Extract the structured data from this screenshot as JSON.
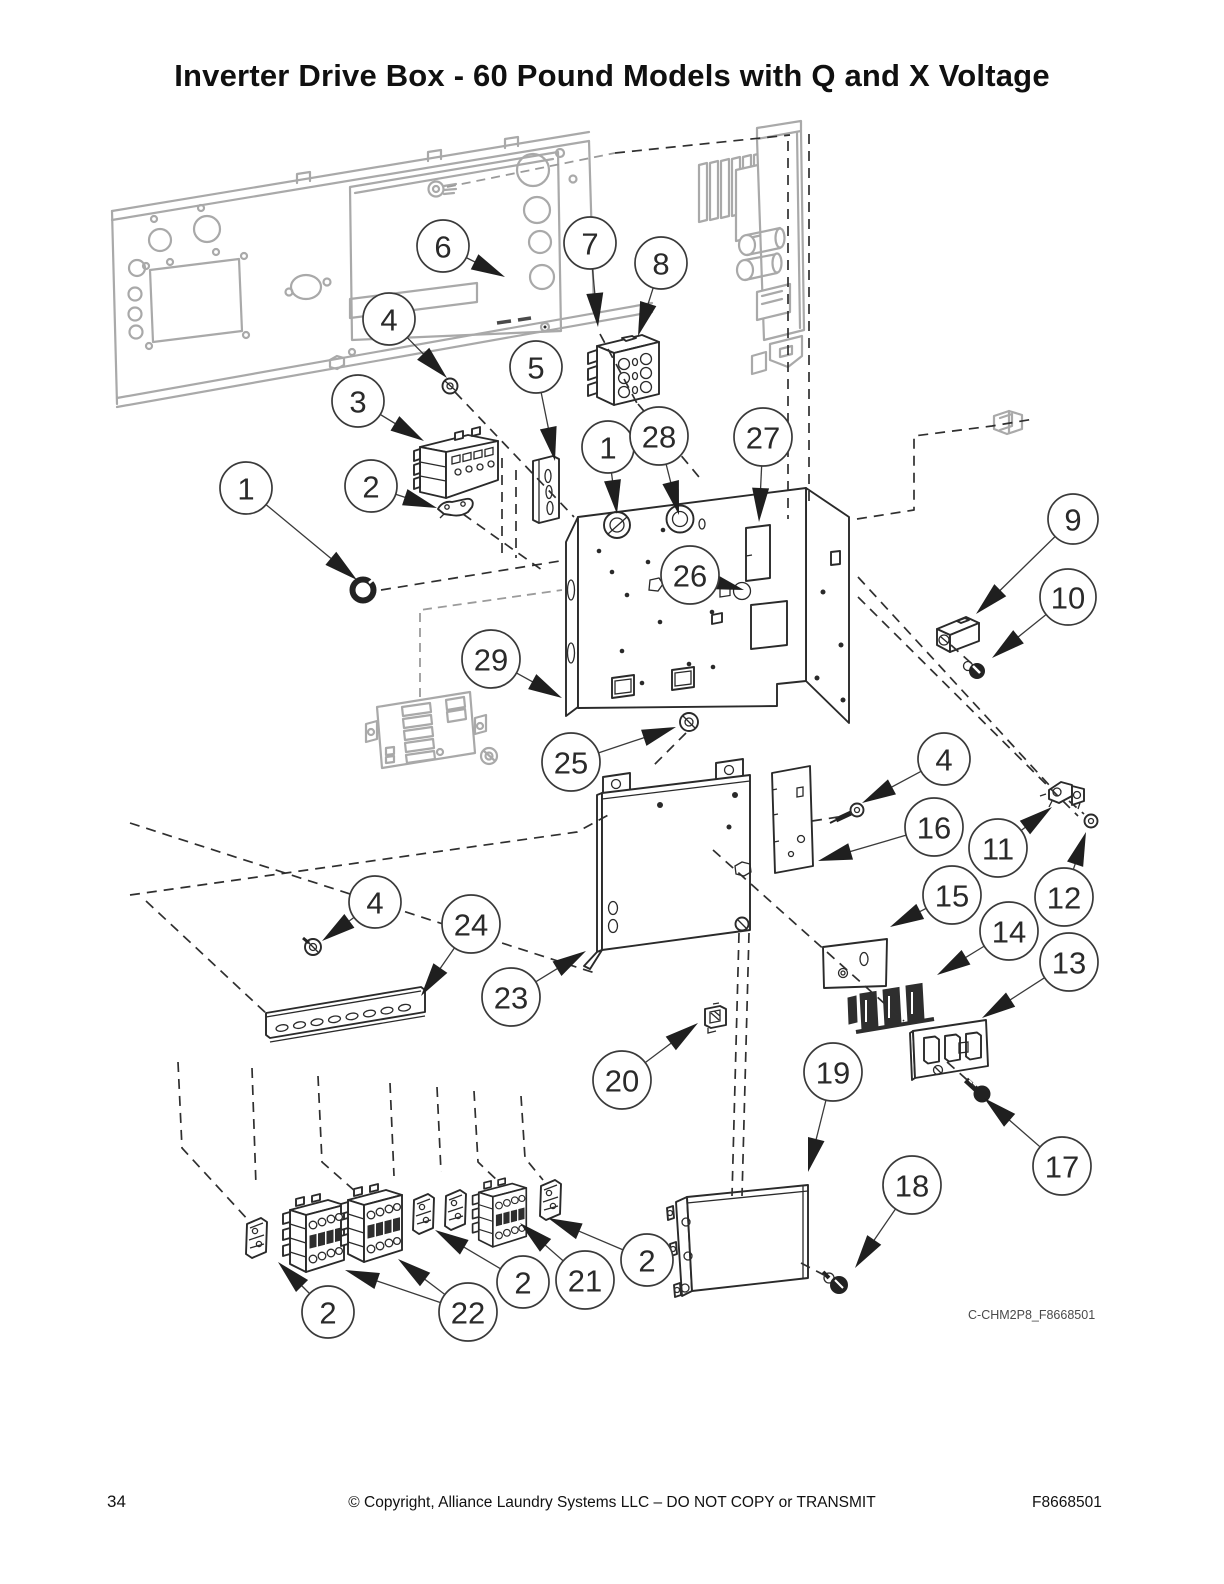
{
  "title": "Inverter Drive Box - 60 Pound Models with Q and X Voltage",
  "diagram_label": "C-CHM2P8_F8668501",
  "footer": {
    "page_number": "34",
    "copyright": "© Copyright, Alliance Laundry Systems LLC – DO NOT COPY or TRANSMIT",
    "document_number": "F8668501"
  },
  "colors": {
    "ink": "#2a2a2a",
    "gray": "#a9a9a9",
    "callout_stroke": "#3a3a3a"
  },
  "callouts": [
    {
      "n": "1",
      "x": 246,
      "y": 488,
      "r": 26,
      "tips": [
        [
          357,
          580
        ]
      ]
    },
    {
      "n": "2",
      "x": 371,
      "y": 486,
      "r": 26,
      "tips": [
        [
          437,
          508
        ]
      ]
    },
    {
      "n": "3",
      "x": 358,
      "y": 401,
      "r": 26,
      "tips": [
        [
          424,
          441
        ]
      ]
    },
    {
      "n": "4",
      "x": 389,
      "y": 319,
      "r": 26,
      "tips": [
        [
          447,
          378
        ]
      ]
    },
    {
      "n": "5",
      "x": 536,
      "y": 367,
      "r": 26,
      "tips": [
        [
          555,
          461
        ]
      ]
    },
    {
      "n": "6",
      "x": 443,
      "y": 246,
      "r": 26,
      "tips": [
        [
          505,
          277
        ]
      ]
    },
    {
      "n": "7",
      "x": 590,
      "y": 243,
      "r": 26,
      "tips": [
        [
          598,
          327
        ]
      ]
    },
    {
      "n": "8",
      "x": 661,
      "y": 263,
      "r": 26,
      "tips": [
        [
          638,
          336
        ]
      ]
    },
    {
      "n": "1",
      "x": 608,
      "y": 447,
      "r": 26,
      "tips": [
        [
          617,
          514
        ]
      ]
    },
    {
      "n": "28",
      "x": 659,
      "y": 436,
      "r": 29,
      "tips": [
        [
          679,
          515
        ]
      ]
    },
    {
      "n": "27",
      "x": 763,
      "y": 437,
      "r": 29,
      "tips": [
        [
          759,
          522
        ]
      ]
    },
    {
      "n": "26",
      "x": 690,
      "y": 575,
      "r": 29,
      "tips": [
        [
          744,
          590
        ]
      ]
    },
    {
      "n": "9",
      "x": 1073,
      "y": 519,
      "r": 25,
      "tips": [
        [
          976,
          614
        ]
      ]
    },
    {
      "n": "10",
      "x": 1068,
      "y": 597,
      "r": 28,
      "tips": [
        [
          992,
          658
        ]
      ]
    },
    {
      "n": "29",
      "x": 491,
      "y": 659,
      "r": 29,
      "tips": [
        [
          562,
          698
        ]
      ]
    },
    {
      "n": "25",
      "x": 571,
      "y": 762,
      "r": 29,
      "tips": [
        [
          676,
          727
        ]
      ]
    },
    {
      "n": "4",
      "x": 944,
      "y": 759,
      "r": 26,
      "tips": [
        [
          862,
          803
        ]
      ]
    },
    {
      "n": "16",
      "x": 934,
      "y": 827,
      "r": 29,
      "tips": [
        [
          818,
          861
        ]
      ]
    },
    {
      "n": "11",
      "x": 998,
      "y": 848,
      "r": 29,
      "tips": [
        [
          1052,
          807
        ]
      ]
    },
    {
      "n": "12",
      "x": 1064,
      "y": 897,
      "r": 29,
      "tips": [
        [
          1086,
          832
        ]
      ]
    },
    {
      "n": "15",
      "x": 952,
      "y": 895,
      "r": 29,
      "tips": [
        [
          890,
          927
        ]
      ]
    },
    {
      "n": "14",
      "x": 1009,
      "y": 931,
      "r": 29,
      "tips": [
        [
          937,
          975
        ]
      ]
    },
    {
      "n": "13",
      "x": 1069,
      "y": 962,
      "r": 29,
      "tips": [
        [
          982,
          1018
        ]
      ]
    },
    {
      "n": "4",
      "x": 375,
      "y": 902,
      "r": 26,
      "tips": [
        [
          322,
          941
        ]
      ]
    },
    {
      "n": "24",
      "x": 471,
      "y": 924,
      "r": 29,
      "tips": [
        [
          421,
          996
        ]
      ]
    },
    {
      "n": "23",
      "x": 511,
      "y": 997,
      "r": 29,
      "tips": [
        [
          586,
          951
        ]
      ]
    },
    {
      "n": "20",
      "x": 622,
      "y": 1080,
      "r": 29,
      "tips": [
        [
          698,
          1023
        ]
      ]
    },
    {
      "n": "19",
      "x": 833,
      "y": 1072,
      "r": 29,
      "tips": [
        [
          808,
          1172
        ]
      ]
    },
    {
      "n": "18",
      "x": 912,
      "y": 1185,
      "r": 29,
      "tips": [
        [
          855,
          1268
        ]
      ]
    },
    {
      "n": "17",
      "x": 1062,
      "y": 1166,
      "r": 29,
      "tips": [
        [
          984,
          1098
        ]
      ]
    },
    {
      "n": "2",
      "x": 328,
      "y": 1312,
      "r": 26,
      "tips": [
        [
          278,
          1262
        ]
      ]
    },
    {
      "n": "22",
      "x": 468,
      "y": 1312,
      "r": 29,
      "tips": [
        [
          345,
          1270
        ],
        [
          398,
          1259
        ]
      ]
    },
    {
      "n": "2",
      "x": 523,
      "y": 1282,
      "r": 26,
      "tips": [
        [
          435,
          1230
        ]
      ]
    },
    {
      "n": "21",
      "x": 585,
      "y": 1280,
      "r": 29,
      "tips": [
        [
          520,
          1223
        ]
      ]
    },
    {
      "n": "2",
      "x": 647,
      "y": 1260,
      "r": 26,
      "tips": [
        [
          548,
          1218
        ]
      ]
    }
  ]
}
